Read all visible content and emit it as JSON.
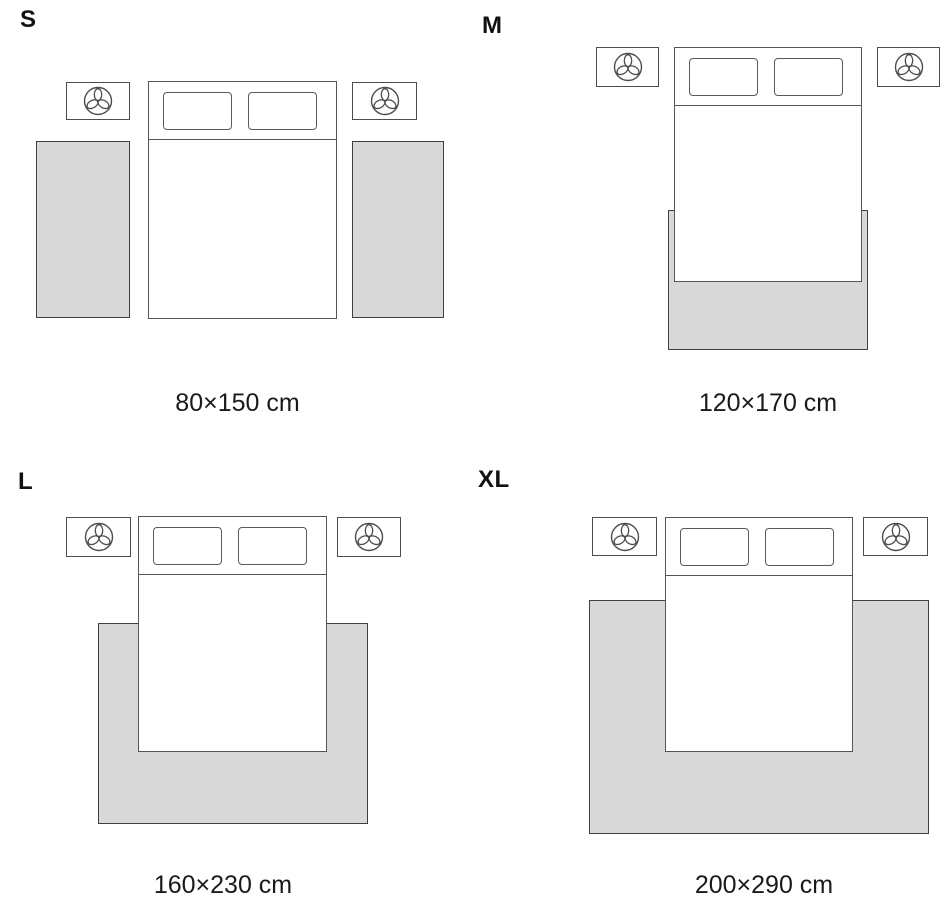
{
  "title": "Rug size guide for bedroom",
  "colors": {
    "background": "#ffffff",
    "rug_fill": "#d9d9d9",
    "rug_outline": "#3f3f3f",
    "furniture_outline": "#555555",
    "text": "#1a1a1a"
  },
  "icons": {
    "nightstand_top": "plant-icon"
  },
  "quadrants": [
    {
      "id": "S",
      "letter": "S",
      "size_label": "80×150 cm",
      "rug_layout": "two runner rugs, one on each side of the bed"
    },
    {
      "id": "M",
      "letter": "M",
      "size_label": "120×170 cm",
      "rug_layout": "single rug under the foot of the bed, slightly wider than the bed"
    },
    {
      "id": "L",
      "letter": "L",
      "size_label": "160×230 cm",
      "rug_layout": "single rug under the lower two-thirds of the bed, extending past both sides"
    },
    {
      "id": "XL",
      "letter": "XL",
      "size_label": "200×290 cm",
      "rug_layout": "single large rug spanning the full width including nightstand zone"
    }
  ]
}
